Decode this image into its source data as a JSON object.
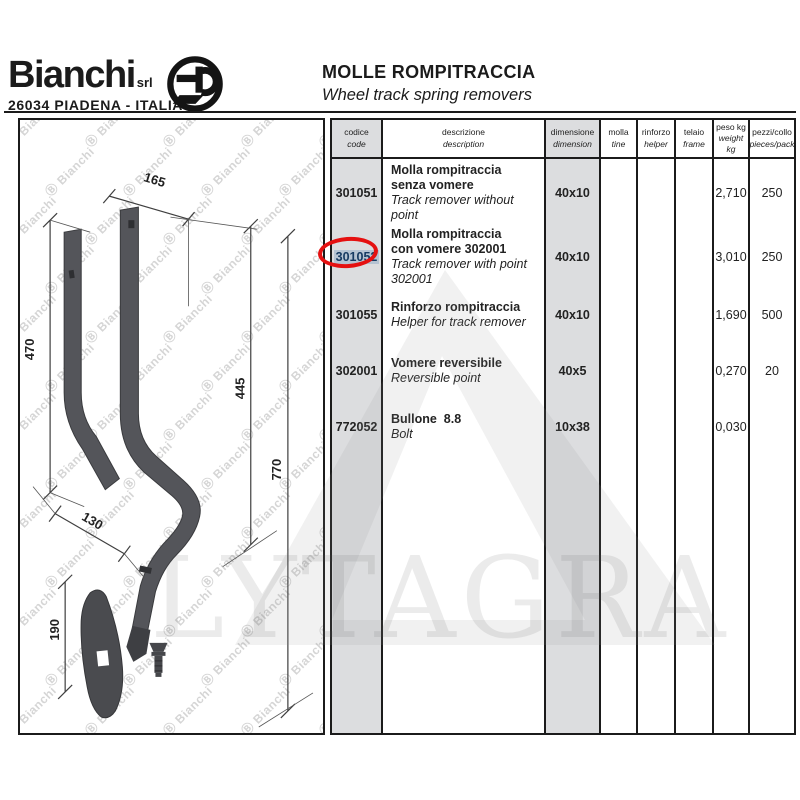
{
  "brand": {
    "name": "Bianchi",
    "suffix": "srl",
    "address": "26034 PIADENA - ITALIA",
    "emblem": "circled-b-logo"
  },
  "header": {
    "title": "MOLLE ROMPITRACCIA",
    "subtitle": "Wheel track spring removers"
  },
  "table": {
    "headers": [
      {
        "it": "codice",
        "en": "code"
      },
      {
        "it": "descrizione",
        "en": "description"
      },
      {
        "it": "dimensione",
        "en": "dimension"
      },
      {
        "it": "molla",
        "en": "tine"
      },
      {
        "it": "rinforzo",
        "en": "helper"
      },
      {
        "it": "telaio",
        "en": "frame"
      },
      {
        "it": "peso kg",
        "en": "weight kg"
      },
      {
        "it": "pezzi/collo",
        "en": "pieces/pack"
      }
    ],
    "rows": [
      {
        "code": "301051",
        "desc_it": [
          "Molla rompitraccia",
          "senza vomere"
        ],
        "desc_en": "Track remover without point",
        "dimension": "40x10",
        "molla": "",
        "rinforzo": "",
        "telaio": "",
        "weight_kg": "2,710",
        "pieces_pack": "250",
        "circled": false
      },
      {
        "code": "301052",
        "desc_it": [
          "Molla rompitraccia",
          "con vomere 302001"
        ],
        "desc_en": "Track remover with point 302001",
        "dimension": "40x10",
        "molla": "",
        "rinforzo": "",
        "telaio": "",
        "weight_kg": "3,010",
        "pieces_pack": "250",
        "circled": true
      },
      {
        "code": "301055",
        "desc_it": [
          "Rinforzo rompitraccia"
        ],
        "desc_en": "Helper for track remover",
        "dimension": "40x10",
        "molla": "",
        "rinforzo": "",
        "telaio": "",
        "weight_kg": "1,690",
        "pieces_pack": "500",
        "circled": false
      },
      {
        "code": "302001",
        "desc_it": [
          "Vomere reversibile"
        ],
        "desc_en": "Reversible point",
        "dimension": "40x5",
        "molla": "",
        "rinforzo": "",
        "telaio": "",
        "weight_kg": "0,270",
        "pieces_pack": "20",
        "circled": false
      },
      {
        "code": "772052",
        "desc_it": [
          "Bullone  8.8"
        ],
        "desc_en": "Bolt",
        "dimension": "10x38",
        "molla": "",
        "rinforzo": "",
        "telaio": "",
        "weight_kg": "0,030",
        "pieces_pack": "",
        "circled": false
      }
    ]
  },
  "drawing": {
    "dimensions": [
      "165",
      "470",
      "445",
      "770",
      "130",
      "190"
    ]
  },
  "watermarks": {
    "pattern_text": "Ⓑ Bianchi",
    "distributor": "LYTAGRA"
  },
  "colors": {
    "circle_red": "#e51010",
    "code_highlight_bg": "#b5c3d2",
    "code_highlight_text": "#163a61",
    "column_gray": "#dcdddf"
  }
}
